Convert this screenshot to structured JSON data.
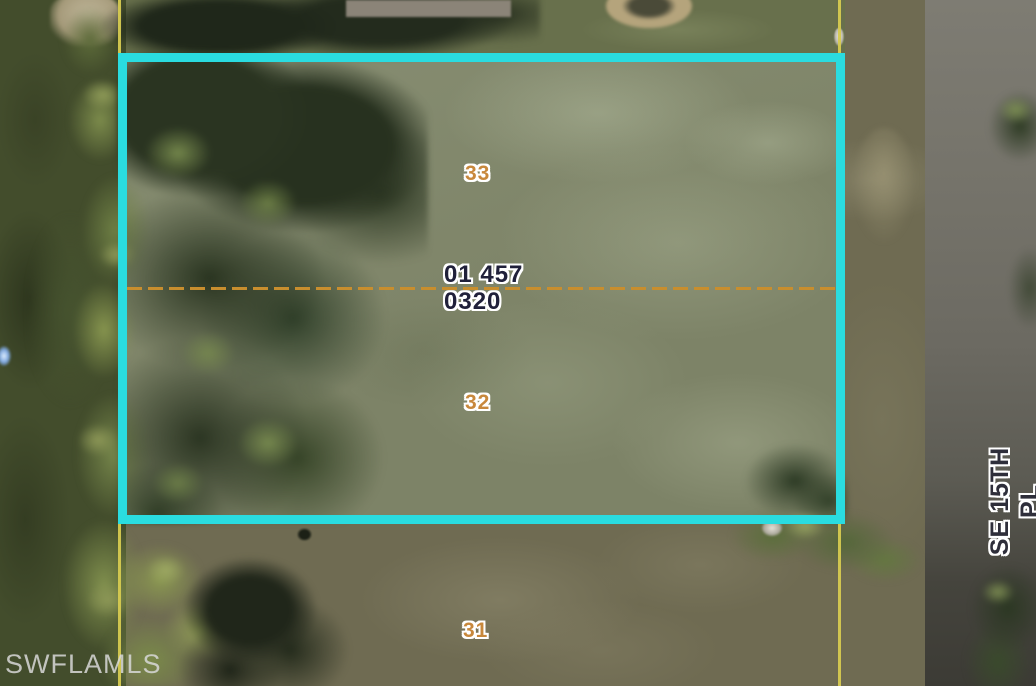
{
  "map": {
    "watermark": "SWFLAMLS",
    "street": {
      "label": "SE 15TH PL"
    },
    "parcel_id": {
      "line1": "01 457",
      "line2": "0320"
    },
    "lots": [
      {
        "number": "33"
      },
      {
        "number": "32"
      },
      {
        "number": "31"
      }
    ],
    "colors": {
      "highlight_border": "#2adce0",
      "parcel_boundary_line": "#d6ca50",
      "lot_split_dashed_line": "#c88e2e",
      "lot_number_text": "#c8883c",
      "parcel_id_text": "#20203a",
      "street_label_text": "#2e2e3a",
      "watermark_text": "#d6d6d6"
    }
  }
}
